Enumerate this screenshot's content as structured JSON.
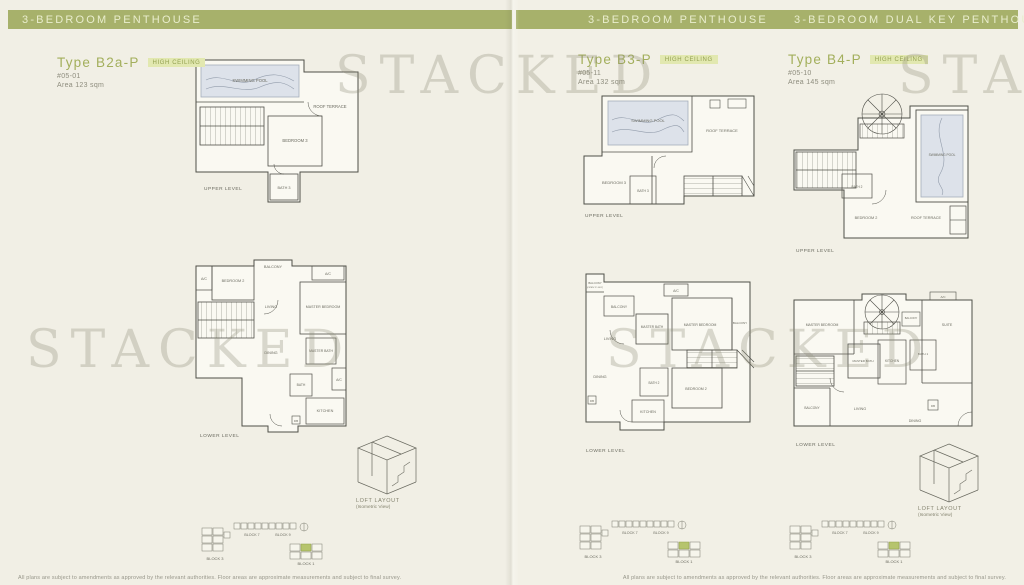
{
  "watermark": {
    "text": "STACKED"
  },
  "colors": {
    "header_bar": "#a7b16b",
    "accent_green": "#a3af5c",
    "badge_bg": "#e2e8b0",
    "pool_fill": "#dde2ea",
    "highlight_unit": "#b6c46d"
  },
  "left_page": {
    "header": "3-BEDROOM PENTHOUSE",
    "unit": {
      "type_label": "Type B2a-P",
      "badge": "HIGH CEILING",
      "unit_no": "#05-01",
      "area": "Area 123 sqm"
    },
    "upper": {
      "caption": "UPPER LEVEL",
      "rooms": {
        "pool": "SWIMMING POOL",
        "terrace": "ROOF TERRACE",
        "bedroom3": "BEDROOM 3",
        "bath3": "BATH 3"
      }
    },
    "lower": {
      "caption": "LOWER LEVEL",
      "rooms": {
        "ac1": "A/C",
        "bedroom2": "BEDROOM 2",
        "balcony": "BALCONY",
        "ac2": "A/C",
        "living": "LIVING",
        "master_bedroom": "MASTER BEDROOM",
        "dining": "DINING",
        "master_bath": "MASTER BATH",
        "bath": "BATH",
        "ac3": "A/C",
        "kitchen": "KITCHEN",
        "db": "DB"
      }
    }
  },
  "right_page": {
    "header_left": "3-BEDROOM PENTHOUSE",
    "header_right": "3-BEDROOM DUAL KEY PENTHOUSE",
    "b3": {
      "unit": {
        "type_label": "Type B3-P",
        "badge": "HIGH CEILING",
        "unit_no": "#05-11",
        "area": "Area 132 sqm"
      },
      "upper": {
        "caption": "UPPER LEVEL",
        "rooms": {
          "pool": "SWIMMING POOL",
          "terrace": "ROOF TERRACE",
          "bedroom3": "BEDROOM 3",
          "bath3": "BATH 3"
        }
      },
      "lower": {
        "caption": "LOWER LEVEL",
        "rooms": {
          "balcony_top": "BALCONY",
          "balcony_top_sub": "(OPEN TO SKY)",
          "balcony_left": "BALCONY",
          "ac": "A/C",
          "master_bath": "MASTER BATH",
          "master_bedroom": "MASTER BEDROOM",
          "balcony_right": "BALCONY",
          "living": "LIVING",
          "dining": "DINING",
          "bath2": "BATH 2",
          "bedroom2": "BEDROOM 2",
          "kitchen": "KITCHEN",
          "db": "DB"
        }
      }
    },
    "b4": {
      "unit": {
        "type_label": "Type B4-P",
        "badge": "HIGH CEILING",
        "unit_no": "#05-10",
        "area": "Area 145 sqm"
      },
      "upper": {
        "caption": "UPPER LEVEL",
        "rooms": {
          "bath2": "BATH 2",
          "pool": "SWIMMING POOL",
          "bedroom2": "BEDROOM 2",
          "terrace": "ROOF TERRACE"
        }
      },
      "lower": {
        "caption": "LOWER LEVEL",
        "rooms": {
          "master_bedroom": "MASTER BEDROOM",
          "balcony_small": "BALCONY",
          "ac": "A/C",
          "suite": "SUITE",
          "master_bath": "MASTER BATH",
          "kitchen": "KITCHEN",
          "bath1": "BATH 1",
          "balcony": "BALCONY",
          "living": "LIVING",
          "dining": "DINING",
          "db": "DB"
        }
      }
    }
  },
  "loft": {
    "title": "LOFT LAYOUT",
    "subtitle": "(Isometric View)"
  },
  "keyplan": {
    "block_a": "BLOCK 3",
    "block_b": "BLOCK 7",
    "block_c": "BLOCK 9",
    "block_d": "BLOCK 1"
  },
  "disclaimer": "All plans are subject to amendments as approved by the relevant authorities. Floor areas are approximate measurements and subject to final survey."
}
